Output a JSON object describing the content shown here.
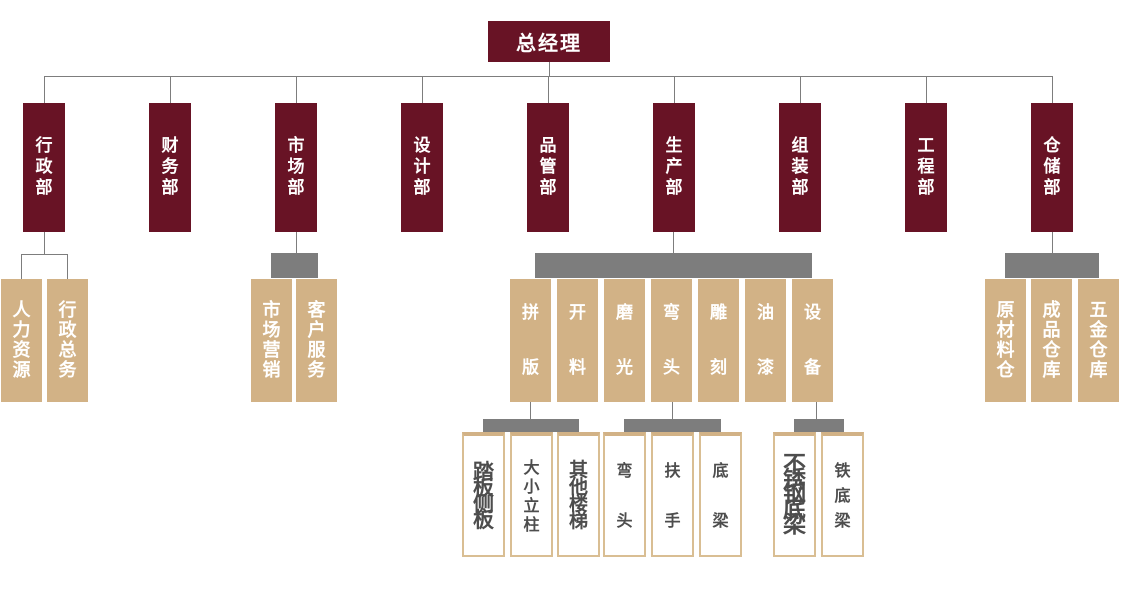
{
  "org": {
    "root": {
      "label": "总经理"
    },
    "departments": [
      {
        "label": "行政部",
        "children": [
          {
            "label": "人力资源"
          },
          {
            "label": "行政总务"
          }
        ]
      },
      {
        "label": "财务部",
        "children": []
      },
      {
        "label": "市场部",
        "children": [
          {
            "label": "市场营销"
          },
          {
            "label": "客户服务"
          }
        ]
      },
      {
        "label": "设计部",
        "children": []
      },
      {
        "label": "品管部",
        "children": []
      },
      {
        "label": "生产部",
        "children": [
          {
            "label": "拼版",
            "children": [
              {
                "label": "踏板侧板"
              },
              {
                "label": "大小立柱"
              },
              {
                "label": "其他楼梯"
              }
            ]
          },
          {
            "label": "开料",
            "children": []
          },
          {
            "label": "磨光",
            "children": []
          },
          {
            "label": "弯头",
            "children": [
              {
                "label": "弯头"
              },
              {
                "label": "扶手"
              },
              {
                "label": "底梁"
              }
            ]
          },
          {
            "label": "雕刻",
            "children": []
          },
          {
            "label": "油漆",
            "children": []
          },
          {
            "label": "设备",
            "children": [
              {
                "label": "不锈钢底梁"
              },
              {
                "label": "铁底梁"
              }
            ]
          }
        ]
      },
      {
        "label": "组装部",
        "children": []
      },
      {
        "label": "工程部",
        "children": []
      },
      {
        "label": "仓储部",
        "children": [
          {
            "label": "原材料仓"
          },
          {
            "label": "成品仓库"
          },
          {
            "label": "五金仓库"
          }
        ]
      }
    ]
  },
  "colors": {
    "maroon": "#681325",
    "tan": "#d2b286",
    "connector_gray": "#7d7d7d",
    "leaf_border": "#d9be93",
    "leaf_text": "#4d4d4d",
    "text_on_dark": "#ffffff",
    "background": "#ffffff"
  }
}
